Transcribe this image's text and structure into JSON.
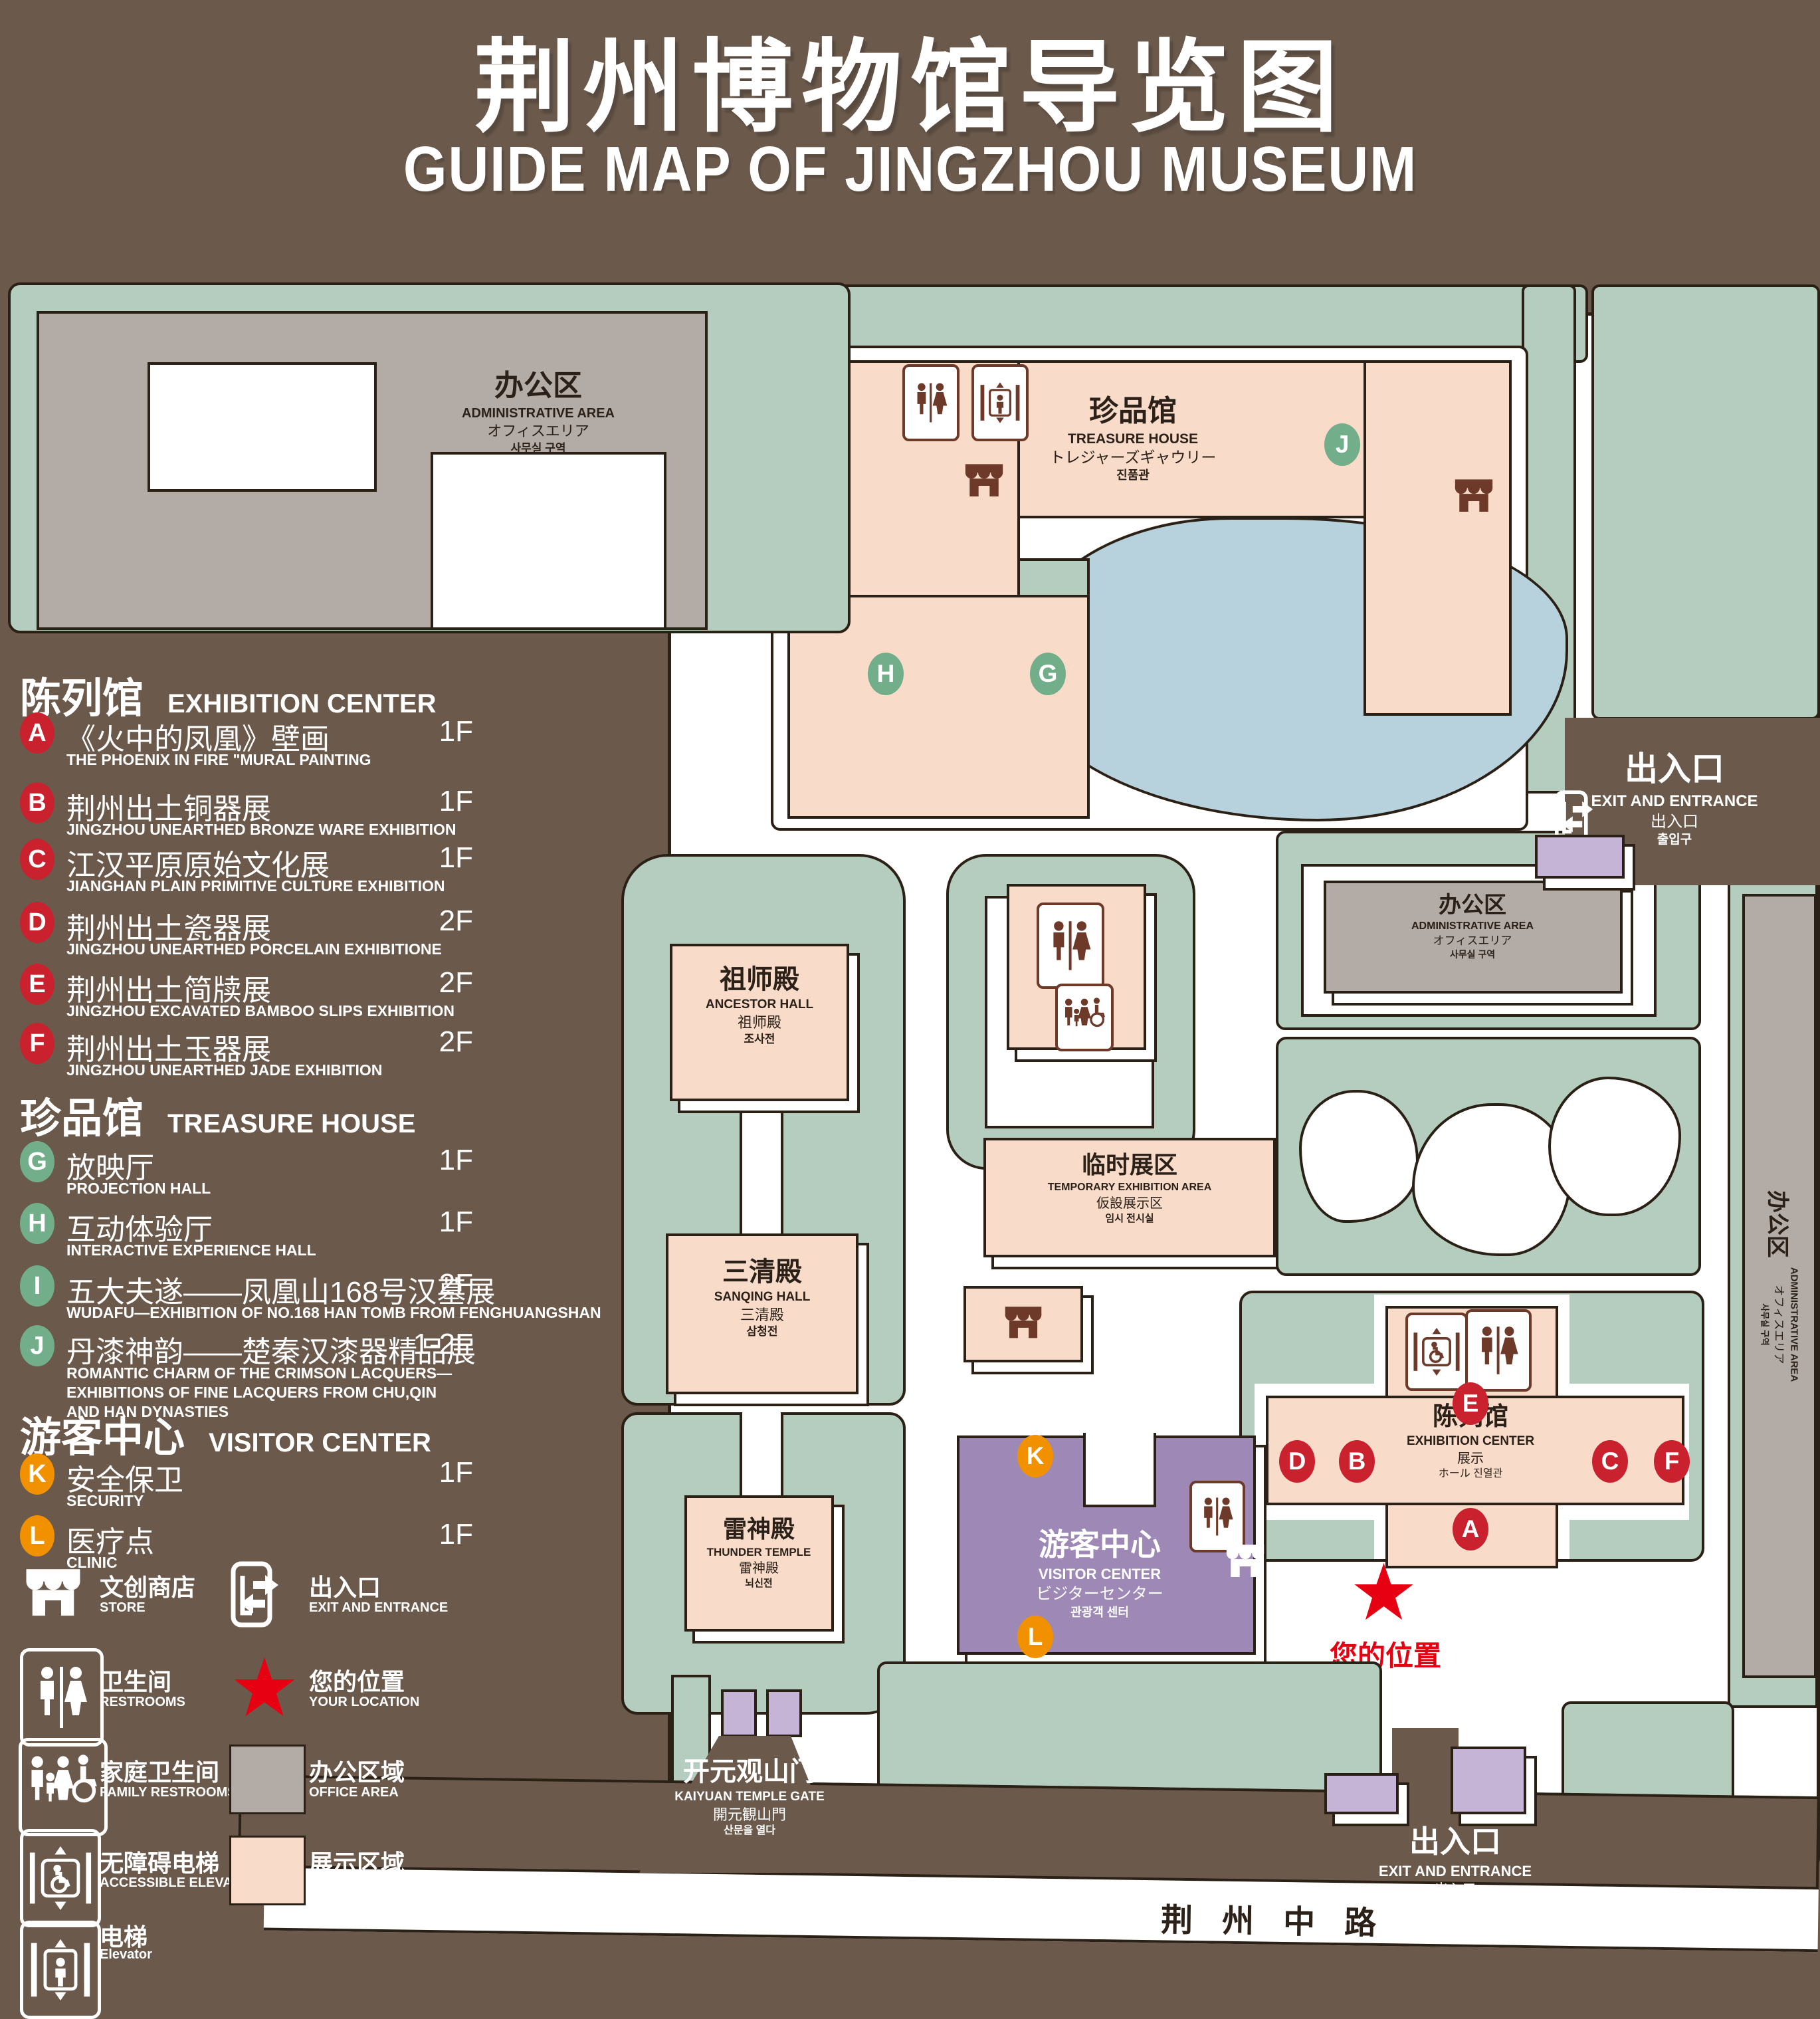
{
  "title": {
    "zh": "荆州博物馆导览图",
    "en": "GUIDE MAP OF JINGZHOU MUSEUM"
  },
  "legend": {
    "sections": [
      {
        "zh": "陈列馆",
        "en": "EXHIBITION CENTER"
      },
      {
        "zh": "珍品馆",
        "en": "TREASURE HOUSE"
      },
      {
        "zh": "游客中心",
        "en": "VISITOR CENTER"
      }
    ],
    "items": [
      {
        "key": "A",
        "zh": "《火中的凤凰》壁画",
        "en": "THE PHOENIX IN FIRE \"MURAL PAINTING",
        "floor": "1F"
      },
      {
        "key": "B",
        "zh": "荆州出土铜器展",
        "en": "JINGZHOU UNEARTHED BRONZE WARE EXHIBITION",
        "floor": "1F"
      },
      {
        "key": "C",
        "zh": "江汉平原原始文化展",
        "en": "JIANGHAN PLAIN PRIMITIVE CULTURE EXHIBITION",
        "floor": "1F"
      },
      {
        "key": "D",
        "zh": "荆州出土瓷器展",
        "en": "JINGZHOU UNEARTHED PORCELAIN EXHIBITIONE",
        "floor": "2F"
      },
      {
        "key": "E",
        "zh": "荆州出土简牍展",
        "en": "JINGZHOU EXCAVATED BAMBOO SLIPS EXHIBITION",
        "floor": "2F"
      },
      {
        "key": "F",
        "zh": "荆州出土玉器展",
        "en": "JINGZHOU UNEARTHED JADE EXHIBITION",
        "floor": "2F"
      },
      {
        "key": "G",
        "zh": "放映厅",
        "en": "PROJECTION HALL",
        "floor": "1F"
      },
      {
        "key": "H",
        "zh": "互动体验厅",
        "en": "INTERACTIVE EXPERIENCE HALL",
        "floor": "1F"
      },
      {
        "key": "I",
        "zh": "五大夫遂——凤凰山168号汉墓展",
        "en": "WUDAFU—EXHIBITION OF NO.168 HAN TOMB FROM FENGHUANGSHAN",
        "floor": "2F"
      },
      {
        "key": "J",
        "zh": "丹漆神韵——楚秦汉漆器精品展",
        "en": "ROMANTIC CHARM OF THE CRIMSON LACQUERS—EXHIBITIONS OF FINE LACQUERS FROM CHU,QIN AND HAN DYNASTIES",
        "floor": "1-2F"
      },
      {
        "key": "K",
        "zh": "安全保卫",
        "en": "SECURITY",
        "floor": "1F"
      },
      {
        "key": "L",
        "zh": "医疗点",
        "en": "CLINIC",
        "floor": "1F"
      }
    ],
    "symbols": [
      {
        "zh": "文创商店",
        "en": "STORE",
        "icon": "store-icon"
      },
      {
        "zh": "出入口",
        "en": "EXIT AND ENTRANCE",
        "icon": "exit-icon"
      },
      {
        "zh": "卫生间",
        "en": "RESTROOMS",
        "icon": "restrooms-icon"
      },
      {
        "zh": "您的位置",
        "en": "YOUR LOCATION",
        "icon": "location-star-icon"
      },
      {
        "zh": "家庭卫生间",
        "en": "FAMILY RESTROOMS",
        "icon": "family-restrooms-icon"
      },
      {
        "zh": "办公区域",
        "en": "OFFICE AREA",
        "icon": "office-swatch"
      },
      {
        "zh": "无障碍电梯",
        "en": "ACCESSIBLE ELEVATOR",
        "icon": "accessible-elevator-icon"
      },
      {
        "zh": "展示区域",
        "en": "DISPLAY AREA",
        "icon": "display-swatch"
      },
      {
        "zh": "电梯",
        "en": "Elevator",
        "icon": "elevator-icon"
      }
    ]
  },
  "map": {
    "admin_area": {
      "lines": [
        "办公区",
        "ADMINISTRATIVE AREA",
        "オフィスエリア",
        "사무실 구역"
      ]
    },
    "treasure_house": {
      "lines": [
        "珍品馆",
        "TREASURE HOUSE",
        "トレジャーズギャウリー",
        "진품관"
      ]
    },
    "ancestor_hall": {
      "lines": [
        "祖师殿",
        "ANCESTOR HALL",
        "祖师殿",
        "조사전"
      ]
    },
    "temporary_exhibition": {
      "lines": [
        "临时展区",
        "TEMPORARY EXHIBITION AREA",
        "仮設展示区",
        "임시 전시실"
      ]
    },
    "sanqing_hall": {
      "lines": [
        "三清殿",
        "SANQING HALL",
        "三清殿",
        "삼청전"
      ]
    },
    "thunder_temple": {
      "lines": [
        "雷神殿",
        "THUNDER TEMPLE",
        "雷神殿",
        "뇌신전"
      ]
    },
    "visitor_center": {
      "lines": [
        "游客中心",
        "VISITOR CENTER",
        "ビジターセンター",
        "관광객 센터"
      ]
    },
    "exhibition_center": {
      "lines": [
        "陈列馆",
        "EXHIBITION CENTER",
        "展示",
        "ホール 진열관"
      ]
    },
    "kaiyuan_gate": {
      "lines": [
        "开元观山门",
        "KAIYUAN TEMPLE GATE",
        "開元観山門",
        "산문을 열다"
      ]
    },
    "exit": {
      "lines": [
        "出入口",
        "EXIT AND ENTRANCE",
        "出入口",
        "출입구"
      ]
    },
    "road": "荆州中路",
    "your_location": "您的位置",
    "markers": {
      "A": "A",
      "B": "B",
      "C": "C",
      "D": "D",
      "E": "E",
      "F": "F",
      "G": "G",
      "H": "H",
      "I": "I",
      "J": "J",
      "K": "K",
      "L": "L"
    }
  },
  "colors": {
    "background": "#6b5a4c",
    "campus_green": "#b5cdbf",
    "display_area": "#f8dbc8",
    "office_area": "#b2aba6",
    "lake": "#b7d2dd",
    "visitor_center": "#9e88b6",
    "gate_purple": "#c6b4d6",
    "marker_red": "#c9222e",
    "marker_green": "#72ae8a",
    "marker_orange": "#f19100",
    "location_red": "#e60012",
    "outline": "#2a2016",
    "icon_brown": "#6d3a2a"
  }
}
